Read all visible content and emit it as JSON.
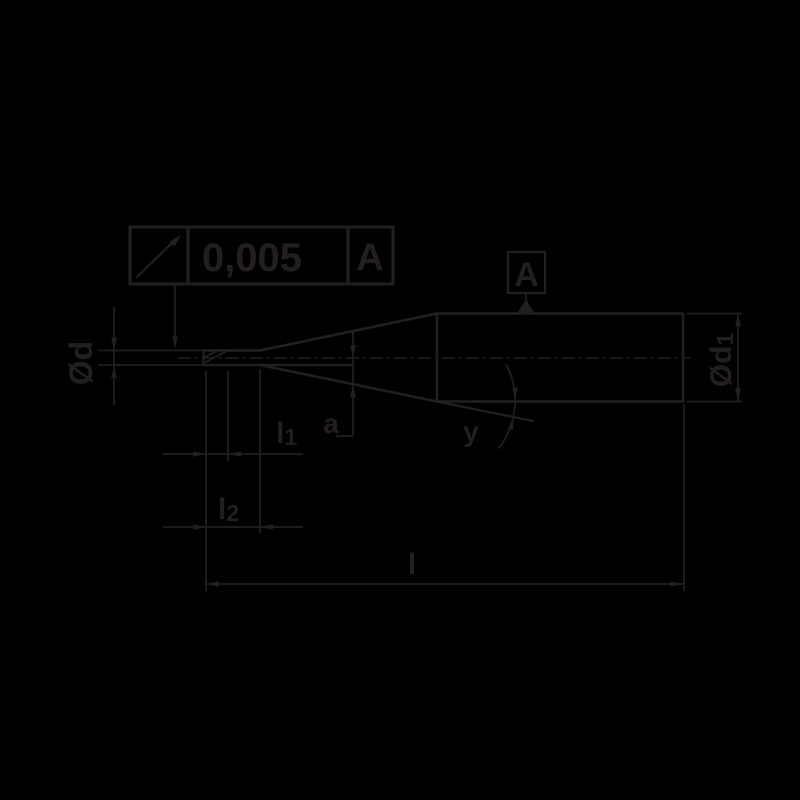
{
  "drawing": {
    "title": "end-mill-dimension-drawing",
    "colors": {
      "background": "#000000",
      "ink": "#231f20"
    },
    "tolerance_frame": {
      "symbol": "circular-runout-arrow",
      "value": "0,005",
      "datum_ref": "A"
    },
    "datum_flag": {
      "label": "A"
    },
    "dimensions": {
      "tip_diameter": {
        "label": "Ød"
      },
      "shank_diameter": {
        "base": "Ød",
        "sub": "1"
      },
      "flute_length": {
        "base": "l",
        "sub": "1"
      },
      "neck_length": {
        "base": "l",
        "sub": "2"
      },
      "overall_length": {
        "label": "l"
      },
      "neck_offset": {
        "label": "a"
      },
      "taper_angle": {
        "label": "y"
      }
    }
  }
}
